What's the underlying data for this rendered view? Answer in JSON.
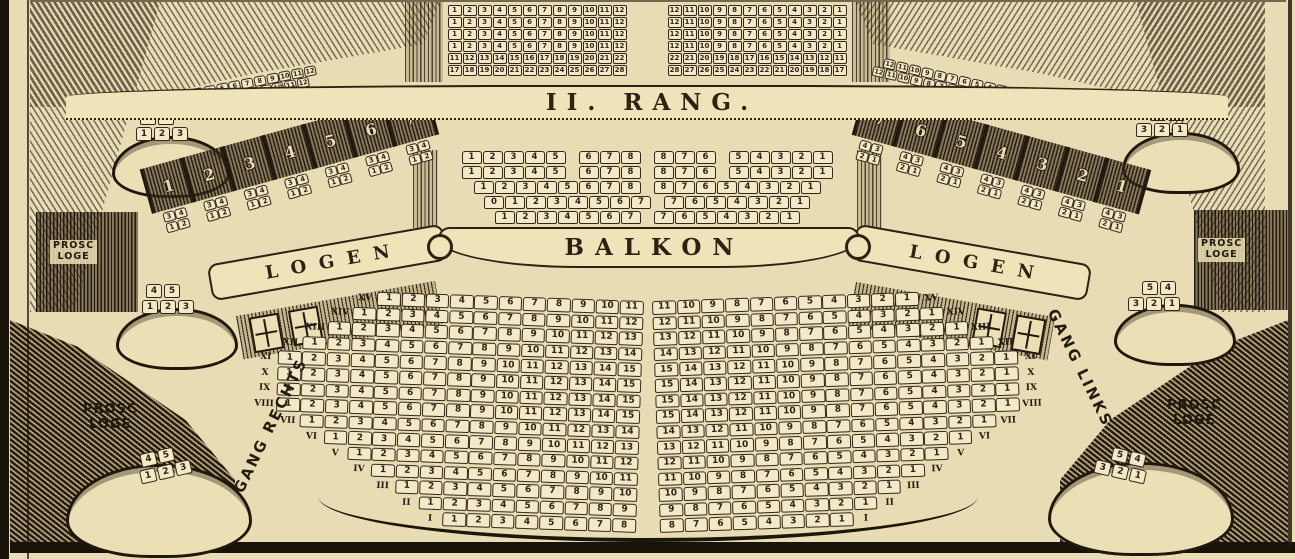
{
  "palette": {
    "paper": "#e8dcb4",
    "ink": "#241c10",
    "seat_fill": "#f2e9c8",
    "ribbon": "#efe3b9"
  },
  "banners": {
    "rang": "II. RANG.",
    "balkon": "BALKON",
    "logen_left": "LOGEN",
    "logen_right": "LOGEN"
  },
  "labels": {
    "prosc": {
      "line1": "PROSC",
      "line2": "LOGE"
    },
    "gang_rechts": "GANG RECHTS",
    "gang_links": "GANG LINKS"
  },
  "rang": {
    "left_rows": [
      [
        1,
        2,
        3,
        4,
        5,
        6,
        7,
        8,
        9,
        10,
        11,
        12
      ],
      [
        1,
        2,
        3,
        4,
        5,
        6,
        7,
        8,
        9,
        10,
        11,
        12
      ],
      [
        1,
        2,
        3,
        4,
        5,
        6,
        7,
        8,
        9,
        10,
        11,
        12
      ],
      [
        1,
        2,
        3,
        4,
        5,
        6,
        7,
        8,
        9,
        10,
        11,
        12
      ],
      [
        11,
        12,
        13,
        14,
        15,
        16,
        17,
        18,
        19,
        20,
        21,
        22
      ],
      [
        17,
        18,
        19,
        20,
        21,
        22,
        23,
        24,
        25,
        26,
        27,
        28
      ]
    ],
    "right_rows": [
      [
        12,
        11,
        10,
        9,
        8,
        7,
        6,
        5,
        4,
        3,
        2,
        1
      ],
      [
        12,
        11,
        10,
        9,
        8,
        7,
        6,
        5,
        4,
        3,
        2,
        1
      ],
      [
        12,
        11,
        10,
        9,
        8,
        7,
        6,
        5,
        4,
        3,
        2,
        1
      ],
      [
        12,
        11,
        10,
        9,
        8,
        7,
        6,
        5,
        4,
        3,
        2,
        1
      ],
      [
        22,
        21,
        20,
        19,
        18,
        17,
        16,
        15,
        14,
        13,
        12,
        11
      ],
      [
        28,
        27,
        26,
        25,
        24,
        23,
        22,
        21,
        20,
        19,
        18,
        17
      ]
    ]
  },
  "galleries": {
    "left": [
      [
        1,
        2,
        3,
        4,
        5,
        6,
        7,
        8,
        9,
        10,
        11,
        12
      ],
      [
        1,
        2,
        3,
        4,
        5,
        6,
        7,
        8,
        9,
        10,
        11,
        12
      ]
    ],
    "right": [
      [
        12,
        11,
        10,
        9,
        8,
        7,
        6,
        5,
        4,
        3,
        2,
        1
      ],
      [
        12,
        11,
        10,
        9,
        8,
        7,
        6,
        5,
        4,
        3,
        2,
        1
      ]
    ]
  },
  "balkon": {
    "rows": [
      [
        [
          1,
          2,
          3,
          4,
          5
        ],
        [
          6,
          7,
          8
        ],
        [
          8,
          7,
          6
        ],
        [
          5,
          4,
          3,
          2,
          1
        ]
      ],
      [
        [
          1,
          2,
          3,
          4,
          5
        ],
        [
          6,
          7,
          8
        ],
        [
          8,
          7,
          6
        ],
        [
          5,
          4,
          3,
          2,
          1
        ]
      ],
      [
        [
          1,
          2,
          3,
          4,
          5,
          6,
          7,
          8
        ],
        [
          8,
          7,
          6,
          5,
          4,
          3,
          2,
          1
        ]
      ],
      [
        [
          0,
          1,
          2,
          3,
          4,
          5,
          6,
          7
        ],
        [
          7,
          6,
          5,
          4,
          3,
          2,
          1
        ]
      ],
      [
        [
          1,
          2,
          3,
          4,
          5,
          6,
          7
        ],
        [
          7,
          6,
          5,
          4,
          3,
          2,
          1
        ]
      ]
    ]
  },
  "logen": {
    "left": {
      "numbers": [
        1,
        2,
        3,
        4,
        5,
        6,
        7
      ],
      "box_seats": [
        [
          3,
          4
        ],
        [
          1,
          2
        ]
      ]
    },
    "right": {
      "numbers": [
        7,
        6,
        5,
        4,
        3,
        2,
        1
      ],
      "box_seats": [
        [
          4,
          3
        ],
        [
          2,
          1
        ]
      ]
    }
  },
  "prosc": {
    "left": {
      "back": [
        4,
        5
      ],
      "front": [
        1,
        2,
        3
      ]
    },
    "right": {
      "back": [
        5,
        4
      ],
      "front": [
        3,
        2,
        1
      ]
    }
  },
  "parkett": {
    "rows": [
      {
        "numeral": "XV",
        "seats": [
          1,
          2,
          3,
          4,
          5,
          6,
          7,
          8,
          9,
          10,
          11
        ]
      },
      {
        "numeral": "XIV",
        "seats": [
          1,
          2,
          3,
          4,
          5,
          6,
          7,
          8,
          9,
          10,
          11,
          12
        ]
      },
      {
        "numeral": "XIII",
        "seats": [
          1,
          2,
          3,
          4,
          5,
          6,
          7,
          8,
          9,
          10,
          11,
          12,
          13
        ]
      },
      {
        "numeral": "XII",
        "seats": [
          1,
          2,
          3,
          4,
          5,
          6,
          7,
          8,
          9,
          10,
          11,
          12,
          13,
          14
        ]
      },
      {
        "numeral": "XI",
        "seats": [
          1,
          2,
          3,
          4,
          5,
          6,
          7,
          8,
          9,
          10,
          11,
          12,
          13,
          14,
          15
        ]
      },
      {
        "numeral": "X",
        "seats": [
          1,
          2,
          3,
          4,
          5,
          6,
          7,
          8,
          9,
          10,
          11,
          12,
          13,
          14,
          15
        ]
      },
      {
        "numeral": "IX",
        "seats": [
          1,
          2,
          3,
          4,
          5,
          6,
          7,
          8,
          9,
          10,
          11,
          12,
          13,
          14,
          15
        ]
      },
      {
        "numeral": "VIII",
        "seats": [
          1,
          2,
          3,
          4,
          5,
          6,
          7,
          8,
          9,
          10,
          11,
          12,
          13,
          14,
          15
        ]
      },
      {
        "numeral": "VII",
        "seats": [
          1,
          2,
          3,
          4,
          5,
          6,
          7,
          8,
          9,
          10,
          11,
          12,
          13,
          14
        ]
      },
      {
        "numeral": "VI",
        "seats": [
          1,
          2,
          3,
          4,
          5,
          6,
          7,
          8,
          9,
          10,
          11,
          12,
          13
        ]
      },
      {
        "numeral": "V",
        "seats": [
          1,
          2,
          3,
          4,
          5,
          6,
          7,
          8,
          9,
          10,
          11,
          12
        ]
      },
      {
        "numeral": "IV",
        "seats": [
          1,
          2,
          3,
          4,
          5,
          6,
          7,
          8,
          9,
          10,
          11
        ]
      },
      {
        "numeral": "III",
        "seats": [
          1,
          2,
          3,
          4,
          5,
          6,
          7,
          8,
          9,
          10
        ]
      },
      {
        "numeral": "II",
        "seats": [
          1,
          2,
          3,
          4,
          5,
          6,
          7,
          8,
          9
        ]
      },
      {
        "numeral": "I",
        "seats": [
          1,
          2,
          3,
          4,
          5,
          6,
          7,
          8
        ]
      }
    ]
  }
}
